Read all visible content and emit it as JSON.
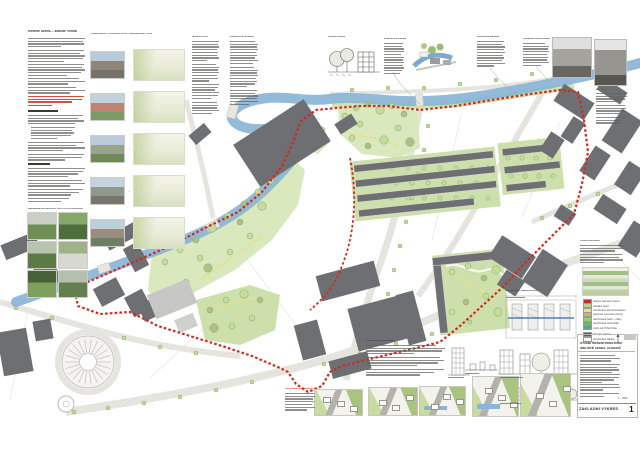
{
  "meta": {
    "sheet_title_line1": "STUDIE ŘEŠENÍ PROSTORU",
    "sheet_title_line2": "SÍDLIŠTĚ VESNA, CHOCEŇ",
    "footer_label": "ZÁKLADNÍ VÝKRES",
    "sheet_number": "1",
    "scale_note": "1 : 1000"
  },
  "palette": {
    "paper": "#ffffff",
    "river": "#8ab5d6",
    "boundary_red": "#cf2b20",
    "red_text": "#c9311f",
    "building_dark": "#6d6f72",
    "building_mid": "#8c8e90",
    "building_light": "#c7c7c5",
    "lawn": "#d9e8bd",
    "lawn2": "#cde0ac",
    "tree_fill": "#c4dd9d",
    "tree_stroke": "#85a964",
    "tree_olive": "#aec08a",
    "road": "#e6e4df",
    "parcel": "#e3e1dc",
    "render_road": "#b4b2ad",
    "render_green": "#a9c47e",
    "render_green2": "#c9dc9f"
  },
  "headers": {
    "intro_title": "Řešené území – sídliště Vesna",
    "comparison": "POROVNÁNÍ – STÁVAJÍCÍ STAV / NAVRHOVANÝ STAV",
    "analysis1": "ŠIRŠÍ VZTAHY",
    "analysis2": "KONCEPCE NÁVRHU",
    "street_profile": "ULIČNÍ PROFIL",
    "greenery": "KONCEPCE ZELENĚ",
    "transport": "DOPRAVNÍ ŘEŠENÍ",
    "public_space": "VEŘEJNÁ PROSTRANSTVÍ",
    "history": "HISTORIE",
    "references": "REFERENČNÍ PŘÍKLADY OBYTNÝCH SOUBORŮ",
    "detail": "DETAIL OBYTNÉHO BLOKU",
    "stages": "ETAPIZACE VÝSTAVBY",
    "axonometry": "AXONOMETRIE NÁVRHU",
    "right_col": "POPIS NÁVRHU",
    "legend_title": "LEGENDA"
  },
  "legend": {
    "items": [
      {
        "color": "#cf2b20",
        "label": "hranice řešeného území"
      },
      {
        "color": "#b7d292",
        "label": "stávající zeleň"
      },
      {
        "color": "#e8e370",
        "label": "navrhované pěší komunikace"
      },
      {
        "color": "#e0a96a",
        "label": "pobytové zpevněné plochy"
      },
      {
        "color": "#9cc87c",
        "label": "navrhovaná zeleň – parky"
      },
      {
        "color": "#74b363",
        "label": "navrhovaná stromořadí"
      },
      {
        "color": "#52a98c",
        "label": "vodní tok Tichá Orlice"
      },
      {
        "color": "#595b5e",
        "label": "stávající objekty"
      },
      {
        "color": "#ffffff",
        "label": "navrhované objekty"
      }
    ]
  },
  "comparison": {
    "pairs": [
      {
        "photo": [
          "#b9cbd8",
          "#8e8478",
          "#75716b"
        ]
      },
      {
        "photo": [
          "#c2d2dc",
          "#c08272",
          "#7d9b66"
        ]
      },
      {
        "photo": [
          "#bccadb",
          "#97a38b",
          "#6e8a58"
        ]
      },
      {
        "photo": [
          "#c5d3de",
          "#8e9a8e",
          "#77766e"
        ]
      },
      {
        "photo": [
          "#bdd0da",
          "#9a8d80",
          "#6d7f62"
        ]
      }
    ]
  },
  "references": {
    "images": [
      {
        "c1": "#c9cfc4",
        "c2": "#6f8f55"
      },
      {
        "c1": "#87a86b",
        "c2": "#4e6e3c"
      },
      {
        "c1": "#b9c4ad",
        "c2": "#5c7a47"
      },
      {
        "c1": "#9fb287",
        "c2": "#d8d8d0"
      },
      {
        "c1": "#47603a",
        "c2": "#7fa05c"
      },
      {
        "c1": "#b5bfae",
        "c2": "#647f4e"
      }
    ]
  },
  "axonometric": {
    "renders": [
      {
        "river": false
      },
      {
        "river": false
      },
      {
        "river": true
      },
      {
        "river": true
      },
      {
        "river": false
      }
    ]
  }
}
